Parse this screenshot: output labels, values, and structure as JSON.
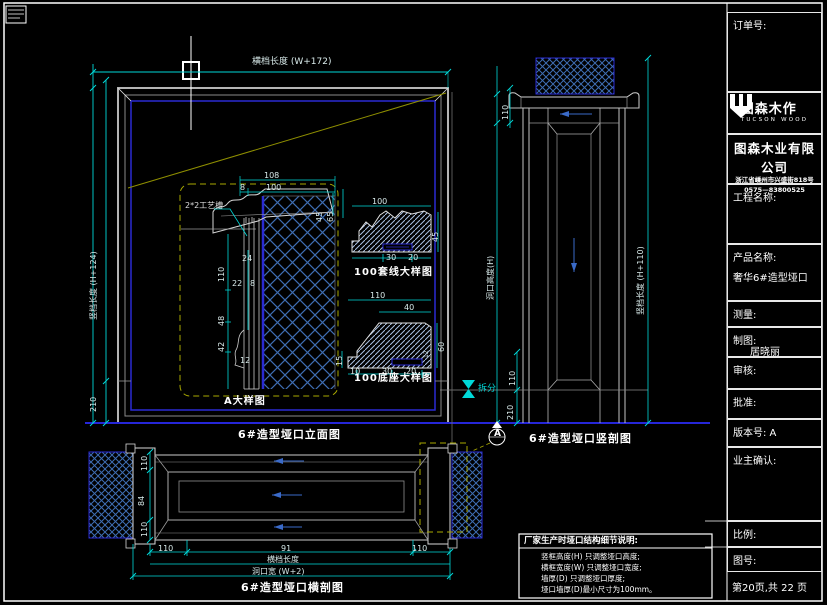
{
  "title_block": {
    "order_label": "订单号:",
    "logo_cn": "图森木作",
    "logo_en": "TUCSON WOOD",
    "company": "图森木业有限公司",
    "address": "浙江省嵊州市兴盛街818号",
    "phone": "0575—83800525",
    "project_label": "工程名称:",
    "product_label": "产品名称:",
    "product_value": "奢华6#造型垭口",
    "measure_label": "测量:",
    "draft_label": "制图:",
    "draft_value": "居晓丽",
    "review_label": "审核:",
    "approve_label": "批准:",
    "version_label": "版本号: A",
    "owner_label": "业主确认:",
    "scale_label": "比例:",
    "drawing_no_label": "图号:",
    "page_info": "第20页,共 22 页"
  },
  "views": {
    "elevation": {
      "title": "6#造型垭口立面图",
      "dim_width": "横档长度 (W+172)",
      "dim_height": "竖档长度 (H+124)",
      "dim_base": "210"
    },
    "detail_a": {
      "title": "A大样图",
      "groove_note": "2*2工艺槽",
      "dims": {
        "d108": "108",
        "d8": "8",
        "d100": "100",
        "d45": "45",
        "d65": "65",
        "d110": "110",
        "d24": "24",
        "d22": "22",
        "d8b": "8",
        "d48": "48",
        "d42": "42",
        "d12": "12"
      }
    },
    "casing_detail": {
      "title": "100套线大样图",
      "dims": {
        "d100": "100",
        "d45": "45",
        "d30": "30",
        "d20": "20"
      }
    },
    "base_detail": {
      "title": "100底座大样图",
      "dims": {
        "d110": "110",
        "d40": "40",
        "d60": "60",
        "d15": "15",
        "d10": "10",
        "d30": "30",
        "d20": "20",
        "d12": "12"
      }
    },
    "vertical_section": {
      "title": "6#造型垭口竖剖图",
      "dim_head": "110",
      "dim_hole": "洞口高度(H)",
      "dim_leg": "竖档长度 (H+110)",
      "dim_110": "110",
      "dim_210": "210",
      "split_label": "拆分",
      "section_mark": "A"
    },
    "horizontal_section": {
      "title": "6#造型垭口横剖图",
      "dim_left_top": "110",
      "dim_left_mid": "84",
      "dim_left_bot": "110",
      "chain": [
        "110",
        "91",
        "110"
      ],
      "dim_row2": "横档长度",
      "dim_row3": "洞口宽 (W+2)"
    }
  },
  "notes": {
    "title": "厂家生产时垭口结构细节说明:",
    "lines": [
      "竖框高度(H) 只调整垭口高度;",
      "横框宽度(W) 只调整垭口宽度;",
      "墙厚(D) 只调整垭口厚度;",
      "垭口墙厚(D)最小尺寸为100mm。"
    ]
  },
  "colors": {
    "background": "#000000",
    "border_white": "#ffffff",
    "line_gray": "#9c9c9c",
    "dimension_cyan": "#00d9d9",
    "frame_blue": "#2a2ad2",
    "hatch_blue": "#3e6db2",
    "construction_olive": "#8f8f00",
    "arrow_blue": "#3a6ac8"
  }
}
